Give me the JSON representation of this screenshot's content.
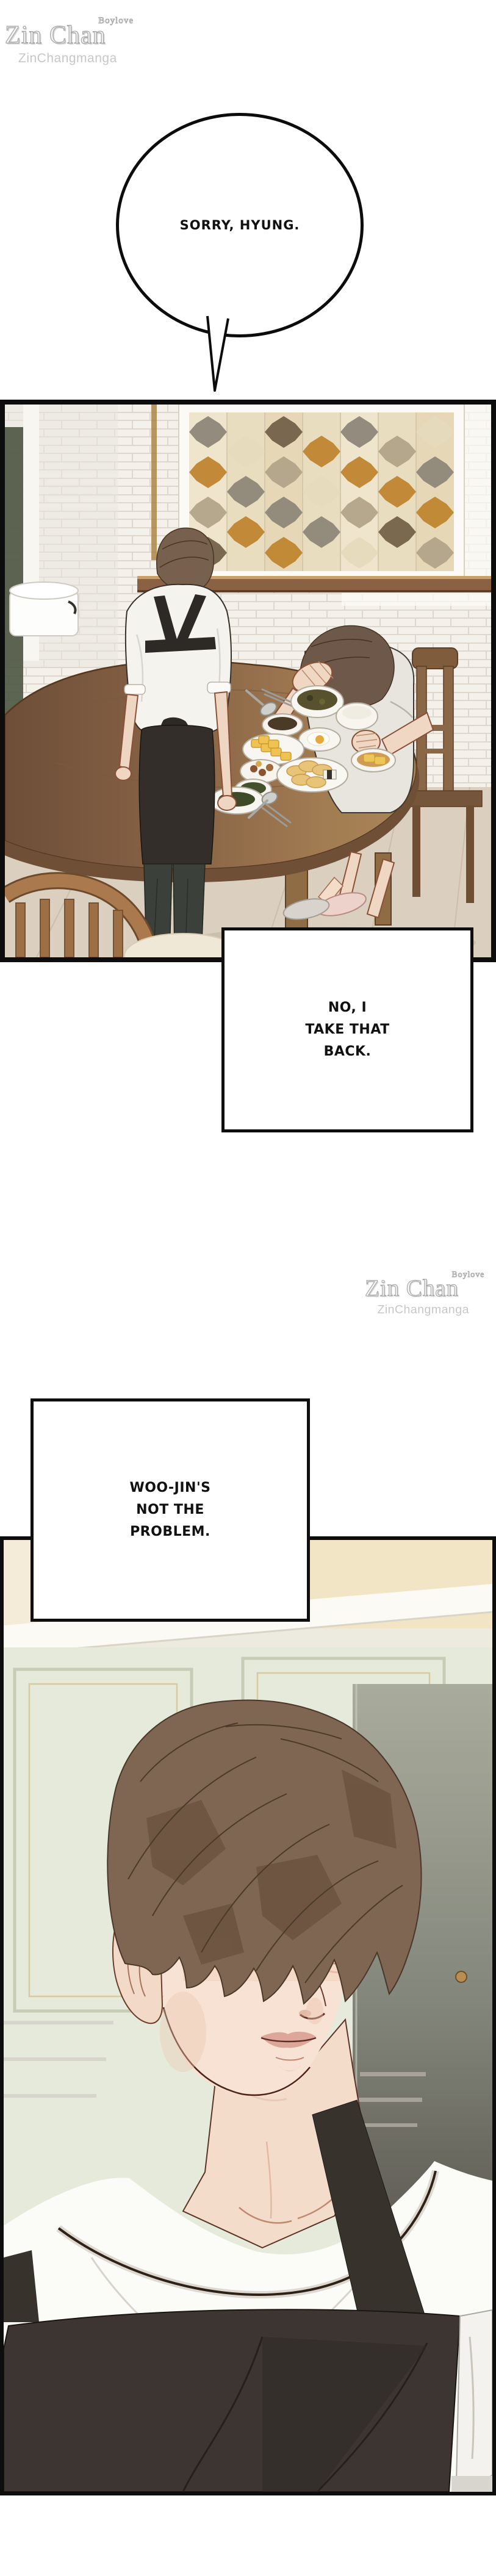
{
  "watermark": {
    "tagline": "Boylove",
    "brand": "Zin Chan",
    "subtitle": "ZinChangmanga",
    "color": "#c7c7c7"
  },
  "dialog": {
    "bubble1": {
      "text": "SORRY, HYUNG."
    },
    "box1": {
      "lines": [
        "NO, I",
        "TAKE THAT",
        "BACK."
      ]
    },
    "box2": {
      "lines": [
        "WOO-JIN'S",
        "NOT THE",
        "PROBLEM."
      ]
    }
  },
  "palette": {
    "paper": "#ffffff",
    "ink": "#0d0d0d",
    "brick_wall": "#f4f1ea",
    "mosaic_amber": "#c08631",
    "mosaic_gray": "#8f8779",
    "mosaic_taupe": "#b2a58a",
    "mosaic_cream": "#e7dbbe",
    "table_wood": "#8a6547",
    "rail_wood": "#8a6243",
    "apron_black": "#332e2a",
    "shirt_white": "#f5f3ee",
    "skin": "#f2dbc8",
    "hair_brown": "#7d6653",
    "floor_wood": "#dbcfbf",
    "wall_beige": "#f2e5c6",
    "cabinet_sage": "#e6eadb",
    "door_dark": "#5a554e",
    "eye_gray": "#98a0a6",
    "lip_rose": "#d9a093",
    "slipper_pink": "#ecd2ca"
  }
}
